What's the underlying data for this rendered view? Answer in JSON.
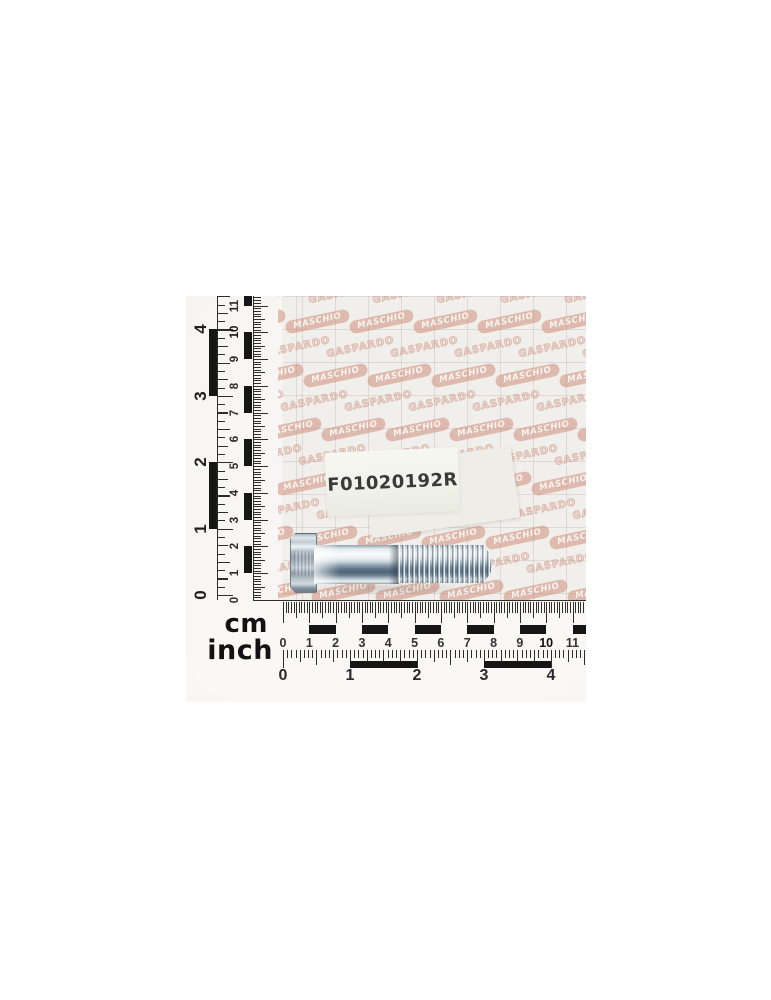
{
  "photo": {
    "subject": "zinc-plated-hex-head-bolt",
    "part_label": "F01020192R",
    "brand_watermarks": {
      "gaspardo": "GASPARDO",
      "maschio": "MASCHIO"
    },
    "rulers": {
      "cm_label": "cm",
      "inch_label": "inch",
      "cm_values": [
        "0",
        "1",
        "2",
        "3",
        "4",
        "5",
        "6",
        "7",
        "8",
        "9",
        "10",
        "11"
      ],
      "inch_values": [
        "0",
        "1",
        "2",
        "3",
        "4"
      ]
    },
    "colors": {
      "watermark_pink": "#cc8873",
      "ruler_ink": "#1f1f1f",
      "label_text": "#3a3a3a",
      "paper": "#f3f2ef",
      "bolt_light": "#eef2f4",
      "bolt_dark": "#5d7182"
    }
  }
}
